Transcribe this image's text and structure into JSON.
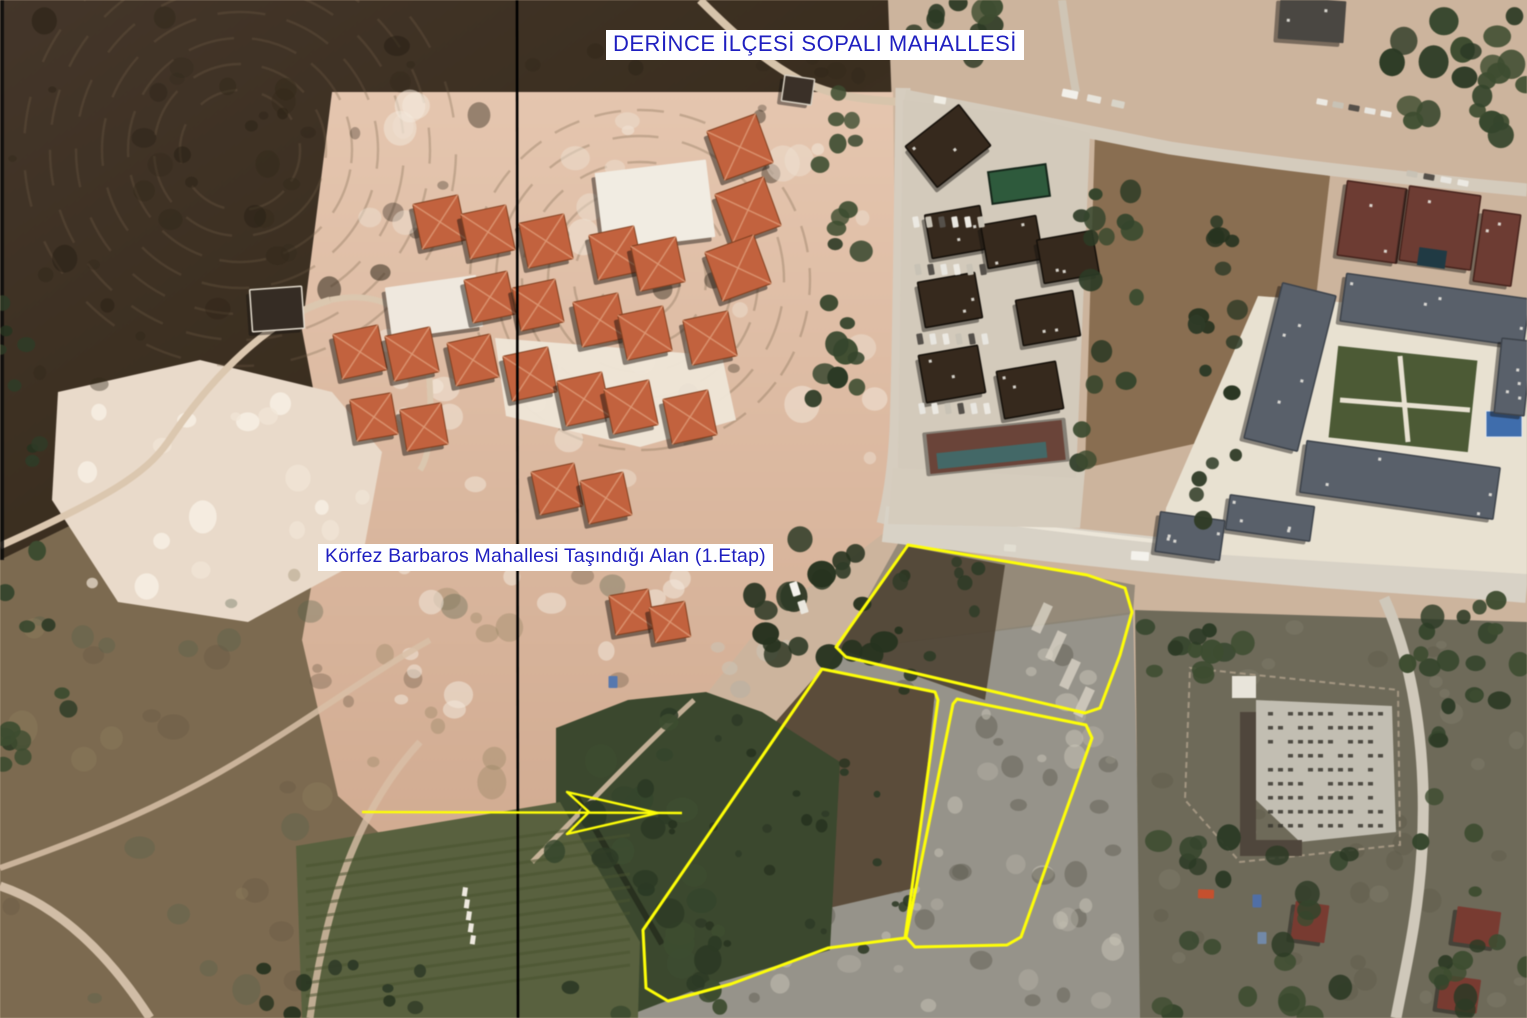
{
  "labels": {
    "district": "DERİNCE İLÇESİ SOPALI MAHALLESİ",
    "relocation_area": "Körfez Barbaros Mahallesi Taşındığı Alan (1.Etap)"
  },
  "annotation_style": {
    "highlight_color": "#ffff00",
    "label_text_color": "#1f1fc0",
    "label_background": "#ffffff",
    "divider_color": "#000000",
    "outline_width": 3
  },
  "map_annotations": {
    "divider_x": 517,
    "parcels": [
      {
        "name": "parcel-north",
        "points": "908,545 1087,575 1125,588 1132,612 1120,655 1100,708 1085,713 846,657 836,647"
      },
      {
        "name": "parcel-southwest",
        "points": "822,669 935,692 938,700 905,938 828,948 731,984 668,1001 646,988 643,930"
      },
      {
        "name": "parcel-southeast",
        "points": "957,699 1086,725 1092,738 1021,937 1007,945 915,947 906,937 953,704"
      }
    ],
    "arrow": {
      "shaft_x1": 362,
      "shaft_y1": 812,
      "shaft_x2": 682,
      "shaft_y2": 813,
      "head_points": "658,813 567,792 589,812 567,834"
    }
  }
}
